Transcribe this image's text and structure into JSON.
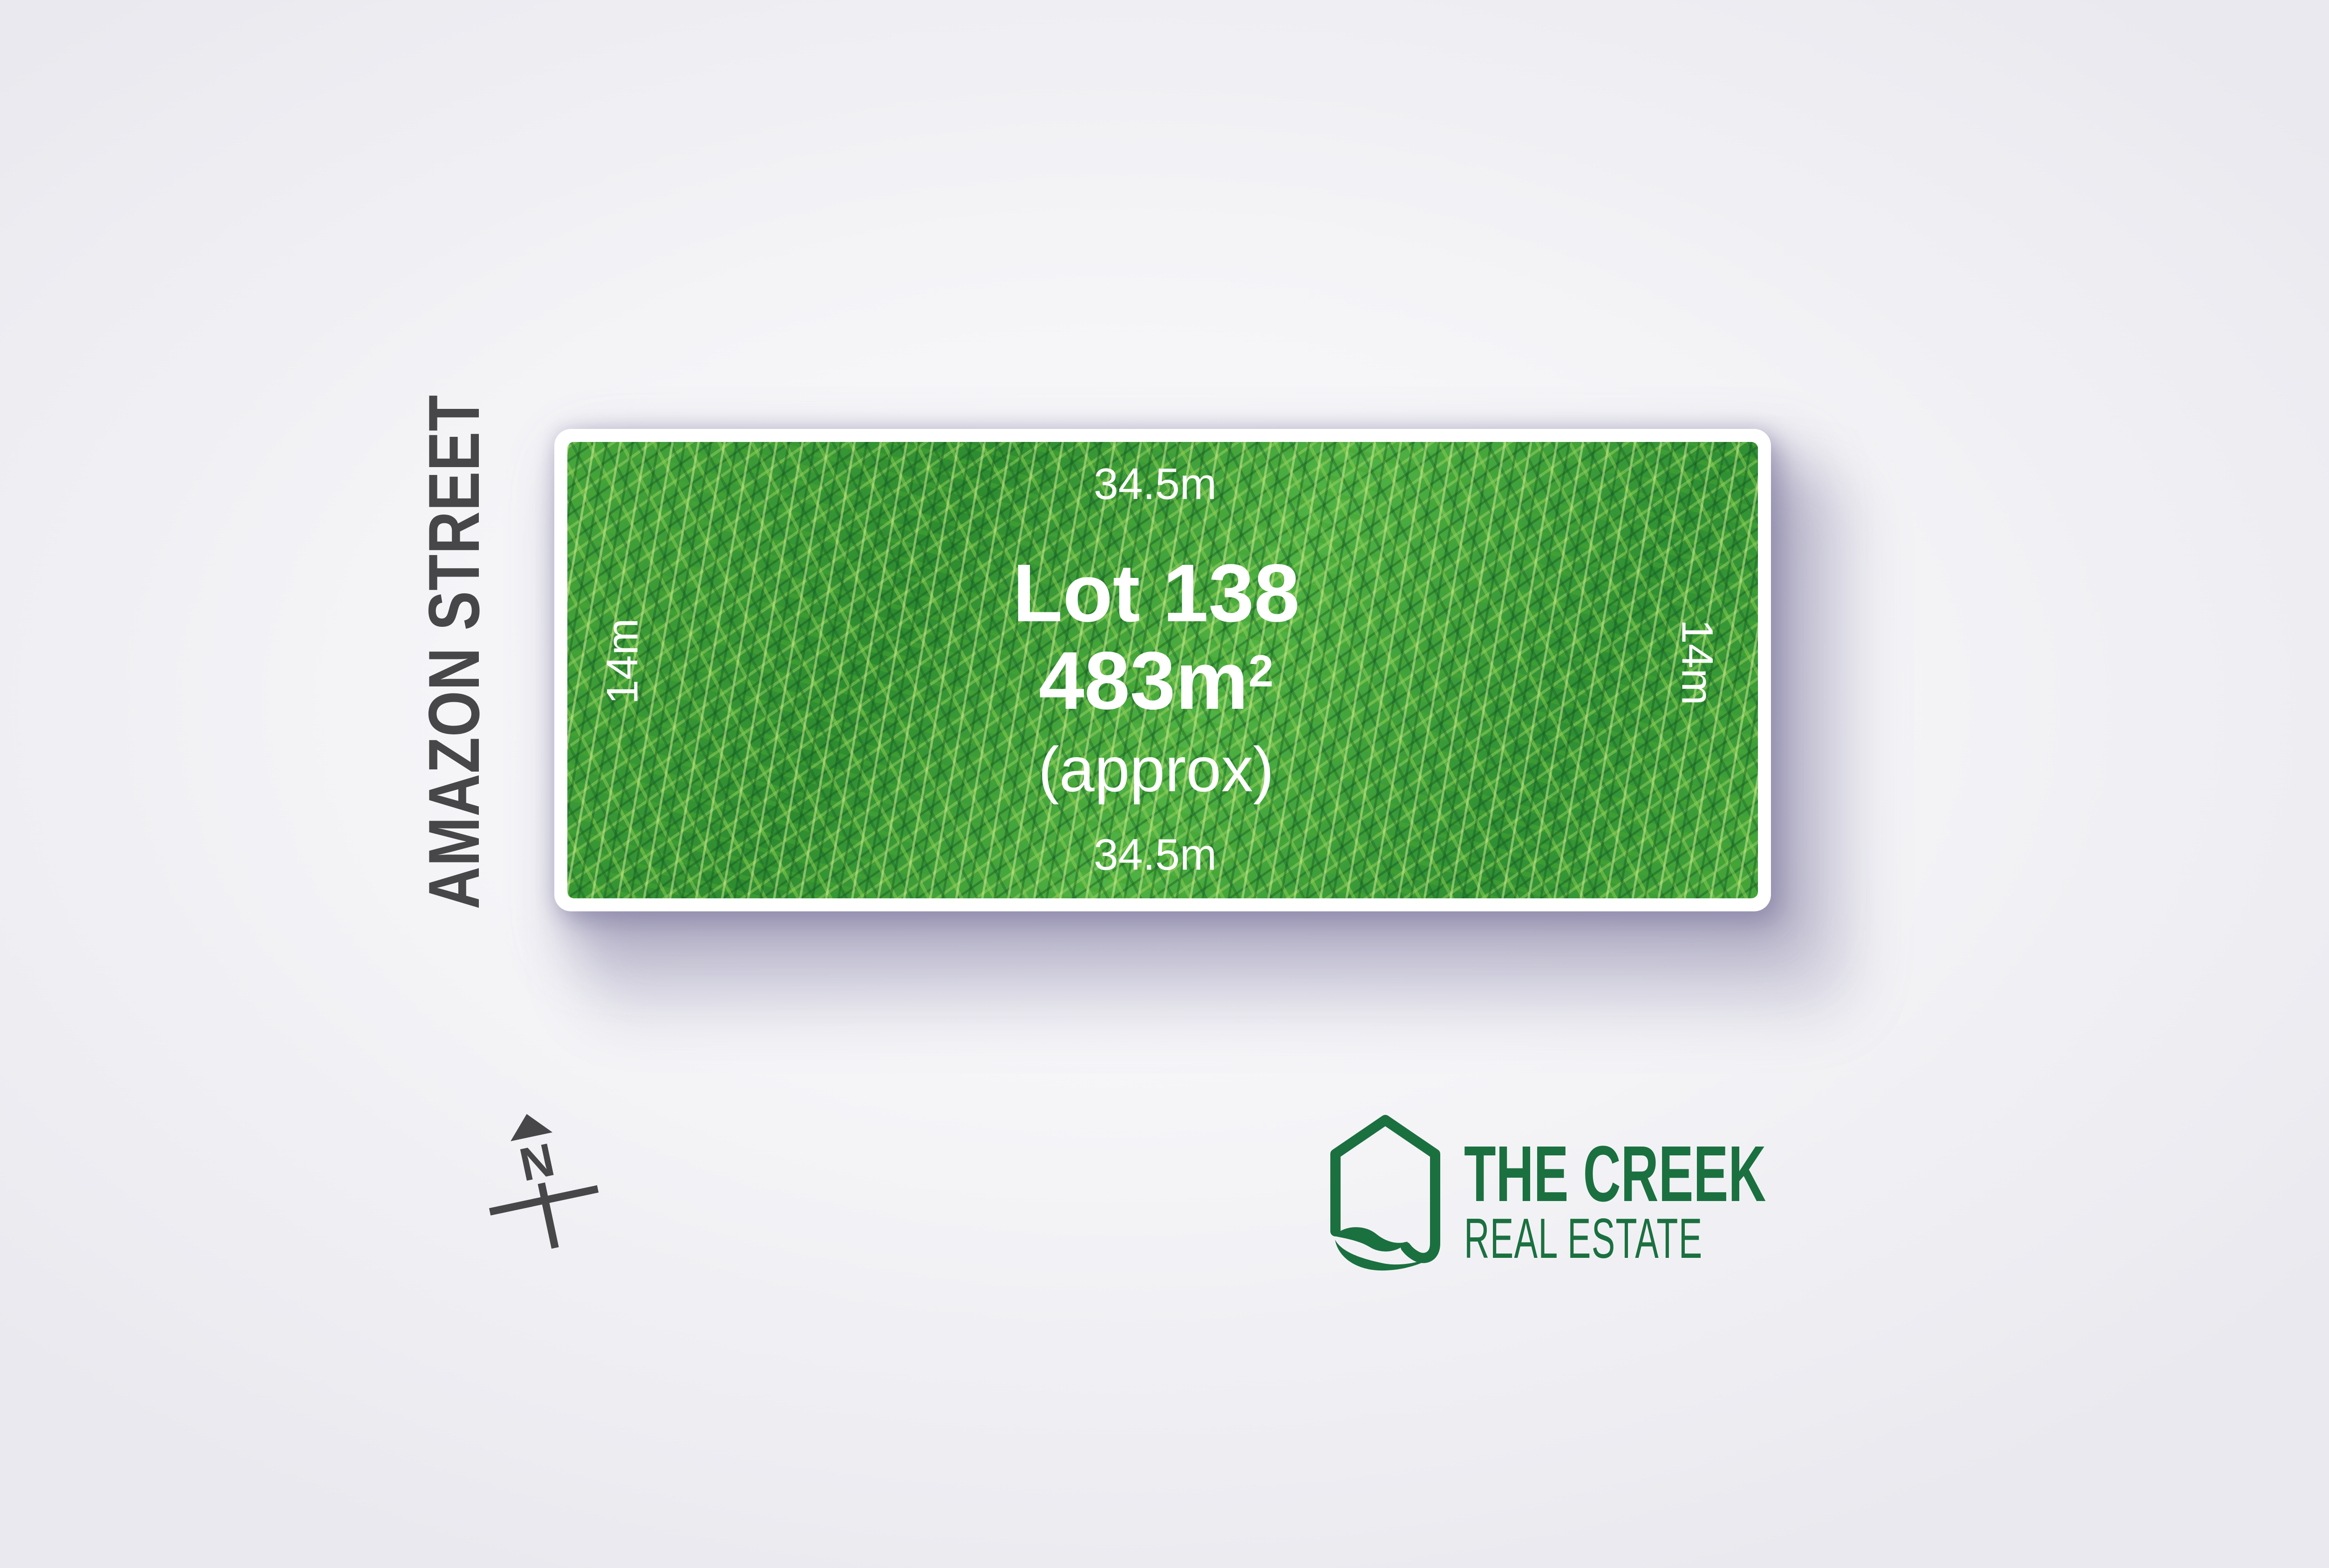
{
  "street": {
    "name": "AMAZON STREET"
  },
  "lot": {
    "number": "Lot 138",
    "area_value": "483m",
    "area_superscript": "2",
    "area_qualifier": "(approx)",
    "frontage_top": "34.5m",
    "frontage_bottom": "34.5m",
    "depth_left": "14m",
    "depth_right": "14m"
  },
  "compass": {
    "north_label": "N"
  },
  "logo": {
    "brand_line1": "THE CREEK",
    "brand_line2": "REAL ESTATE"
  },
  "colors": {
    "brand_green": "#1b7040",
    "label_gray": "#47474a",
    "dimension_text": "#ffffff",
    "grass_green": "#3f9c36",
    "shadow_lavender": "#767198"
  }
}
